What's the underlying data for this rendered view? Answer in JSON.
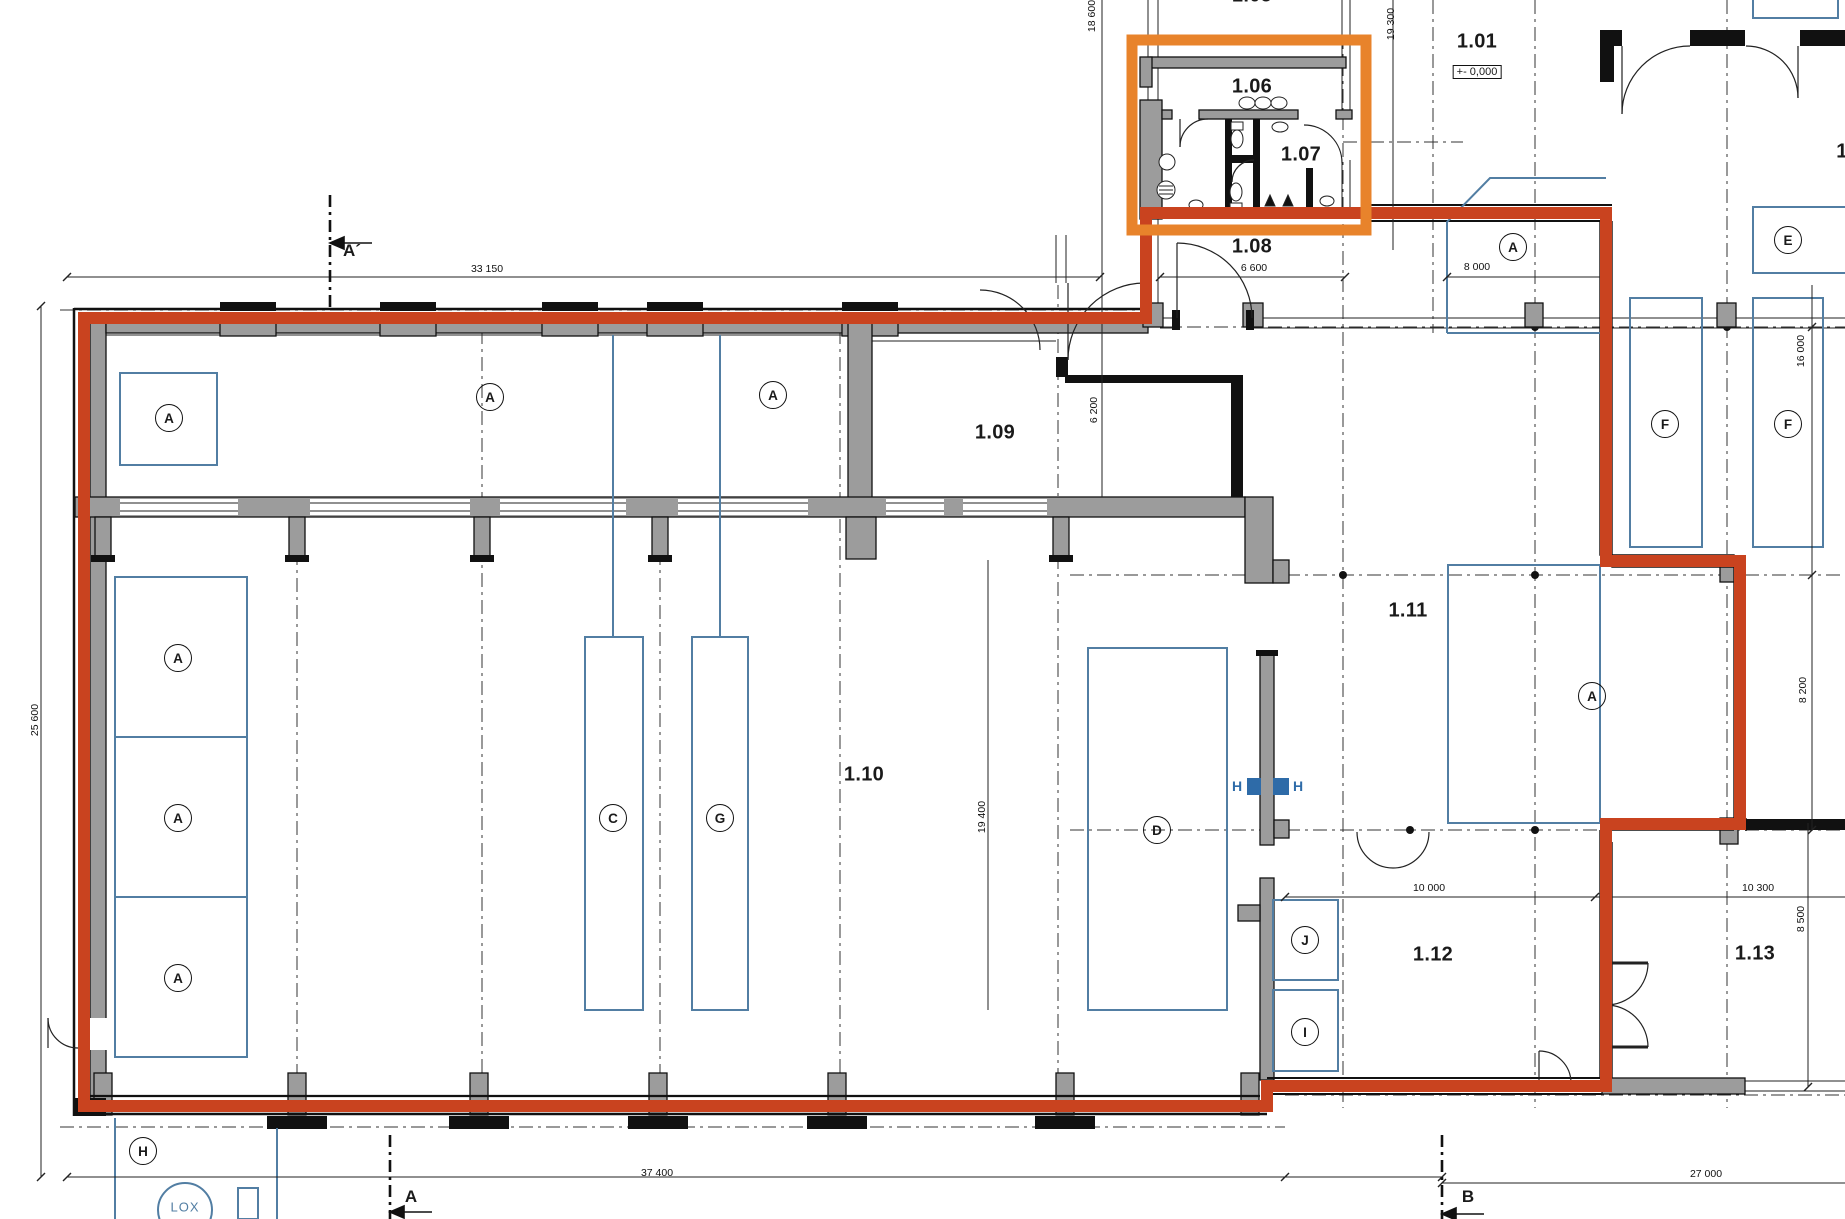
{
  "drawing": {
    "type": "architectural floor plan, ground floor",
    "level_marker": "+- 0,000",
    "highlighted_rooms_in_orange_box": [
      "1.06",
      "1.07"
    ]
  },
  "rooms": [
    {
      "number": "1.05"
    },
    {
      "number": "1.06"
    },
    {
      "number": "1.07"
    },
    {
      "number": "1.08"
    },
    {
      "number": "1.01"
    },
    {
      "number": "1.09"
    },
    {
      "number": "1.10"
    },
    {
      "number": "1.11"
    },
    {
      "number": "1.12"
    },
    {
      "number": "1.13"
    },
    {
      "number": "1"
    }
  ],
  "zones": [
    {
      "letter": "A"
    },
    {
      "letter": "A"
    },
    {
      "letter": "A"
    },
    {
      "letter": "A"
    },
    {
      "letter": "A"
    },
    {
      "letter": "A"
    },
    {
      "letter": "C"
    },
    {
      "letter": "G"
    },
    {
      "letter": "D"
    },
    {
      "letter": "A"
    },
    {
      "letter": "E"
    },
    {
      "letter": "F"
    },
    {
      "letter": "F"
    },
    {
      "letter": "A"
    },
    {
      "letter": "J"
    },
    {
      "letter": "I"
    },
    {
      "letter": "H"
    }
  ],
  "dimensions": [
    {
      "value": "33 150",
      "axis": "h"
    },
    {
      "value": "6 600",
      "axis": "h"
    },
    {
      "value": "8 000",
      "axis": "h"
    },
    {
      "value": "18 600",
      "axis": "v"
    },
    {
      "value": "19 300",
      "axis": "v"
    },
    {
      "value": "6 200",
      "axis": "v"
    },
    {
      "value": "25 600",
      "axis": "v"
    },
    {
      "value": "19 400",
      "axis": "v"
    },
    {
      "value": "16 000",
      "axis": "v"
    },
    {
      "value": "8 200",
      "axis": "v"
    },
    {
      "value": "10 000",
      "axis": "h"
    },
    {
      "value": "10 300",
      "axis": "h"
    },
    {
      "value": "8 500",
      "axis": "v"
    },
    {
      "value": "37 400",
      "axis": "h"
    },
    {
      "value": "27 000",
      "axis": "h"
    }
  ],
  "section_markers": [
    {
      "label": "A´"
    },
    {
      "label": "A"
    },
    {
      "label": "B"
    }
  ],
  "hydrant_marker": {
    "left": "H",
    "right": "H"
  },
  "site_label": {
    "text": "LOX"
  },
  "colors": {
    "highlight_path": "#c9431f",
    "highlight_box": "#e8832b",
    "zone_blue": "#527ea3",
    "marker_blue": "#2e6ba8",
    "wall_gray": "#9c9c9c"
  }
}
